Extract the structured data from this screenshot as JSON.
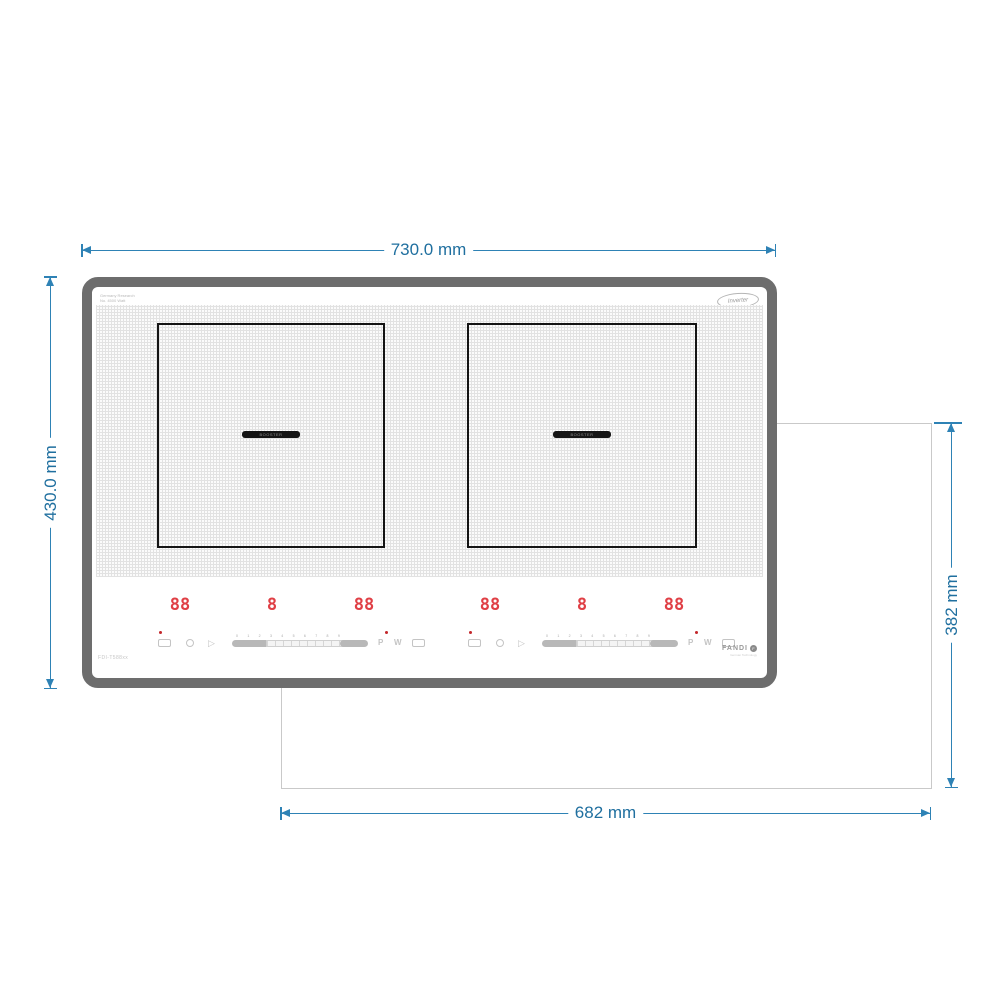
{
  "dimensions": {
    "top_width": "730.0 mm",
    "left_height": "430.0 mm",
    "right_cutout_height": "382 mm",
    "bottom_cutout_width": "682 mm"
  },
  "cooktop": {
    "fine_print": [
      "Germany Research",
      "No. 4500 Watt"
    ],
    "inverter_badge": "Inverter",
    "model_code": "FDI-T588xx",
    "brand": "FANDI",
    "brand_mark": "F",
    "brand_subtext": "German Technology",
    "zones": [
      {
        "booster_label": "BOOSTER"
      },
      {
        "booster_label": "BOOSTER"
      }
    ],
    "controls": {
      "slider_scale": "0 1 2 3 4 5 6 7 8 9",
      "groups": [
        {
          "displays": [
            "88",
            "8",
            "88"
          ],
          "boost_label": "P",
          "warm_label": "W"
        },
        {
          "displays": [
            "88",
            "8",
            "88"
          ],
          "boost_label": "P",
          "warm_label": "W"
        }
      ]
    }
  },
  "icons": {
    "start": "▷"
  },
  "colors": {
    "dimension_blue": "#2e82b5",
    "display_red": "#e04046",
    "frame_gray": "#6d6d6d"
  }
}
